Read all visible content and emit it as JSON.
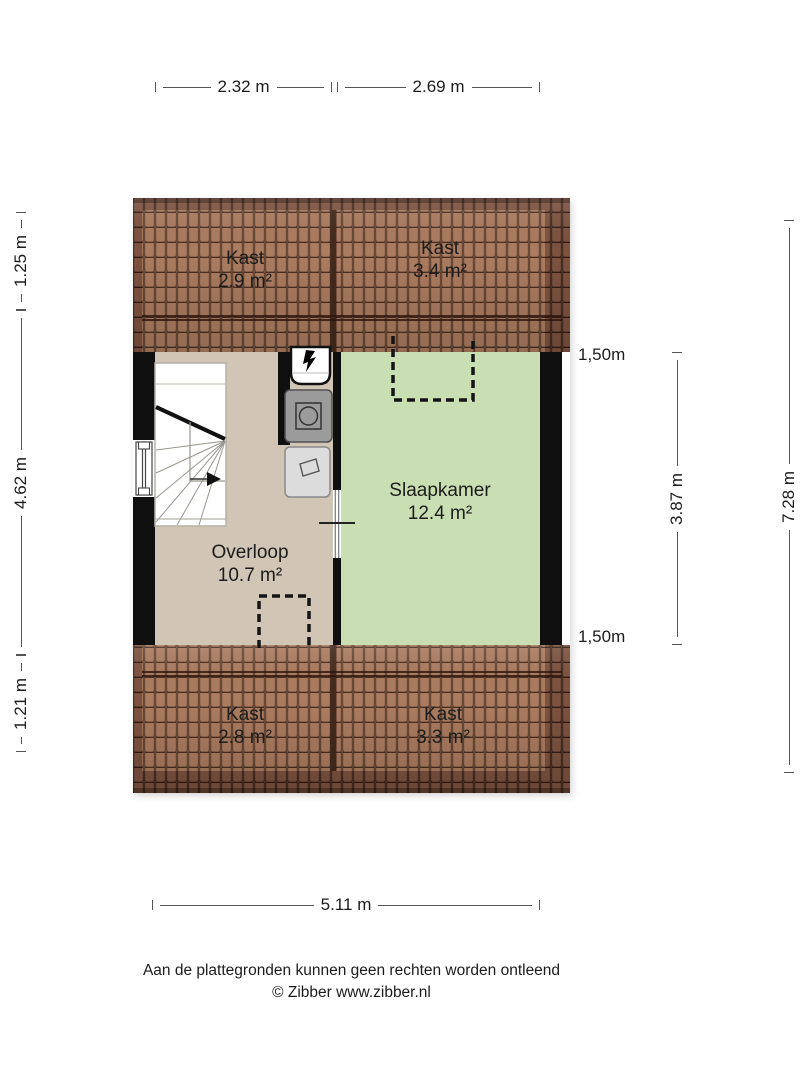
{
  "plan": {
    "rooms": {
      "kast_top_left": {
        "name": "Kast",
        "area": "2.9 m²"
      },
      "kast_top_right": {
        "name": "Kast",
        "area": "3.4 m²"
      },
      "overloop": {
        "name": "Overloop",
        "area": "10.7 m²"
      },
      "slaapkamer": {
        "name": "Slaapkamer",
        "area": "12.4 m²"
      },
      "kast_bottom_left": {
        "name": "Kast",
        "area": "2.8 m²"
      },
      "kast_bottom_right": {
        "name": "Kast",
        "area": "3.3 m²"
      }
    },
    "icons": {
      "staircase": "winder-staircase-with-direction-arrow",
      "window": "window-in-left-wall",
      "door": "door-between-overloop-and-slaapkamer",
      "mechanical_ventilation": "mv-unit-with-lightning-glyph",
      "washing_machine": "washer-square-with-drum-circle",
      "laundry_basket": "basket-outline",
      "dashed_outlines": "low-headroom-dashed-openings"
    }
  },
  "dimensions": {
    "top": [
      {
        "label": "2.32 m"
      },
      {
        "label": "2.69 m"
      }
    ],
    "left": [
      {
        "label": "1.25 m"
      },
      {
        "label": "4.62 m"
      },
      {
        "label": "1.21 m"
      }
    ],
    "right": {
      "marker_top": "1,50m",
      "inner": "3.87 m",
      "outer": "7.28 m",
      "marker_bottom": "1,50m"
    },
    "bottom": {
      "label": "5.11 m"
    }
  },
  "footer": {
    "disclaimer": "Aan de plattegronden kunnen geen rechten worden ontleend",
    "credit": "© Zibber www.zibber.nl"
  },
  "colors": {
    "roof_dark": "#7d5340",
    "roof_light": "#ab7c60",
    "floor_landing": "#d1c5b6",
    "floor_bedroom": "#c9deb2",
    "wall": "#0f0f0f",
    "dim_line": "#555555",
    "text": "#1c1c1c"
  }
}
